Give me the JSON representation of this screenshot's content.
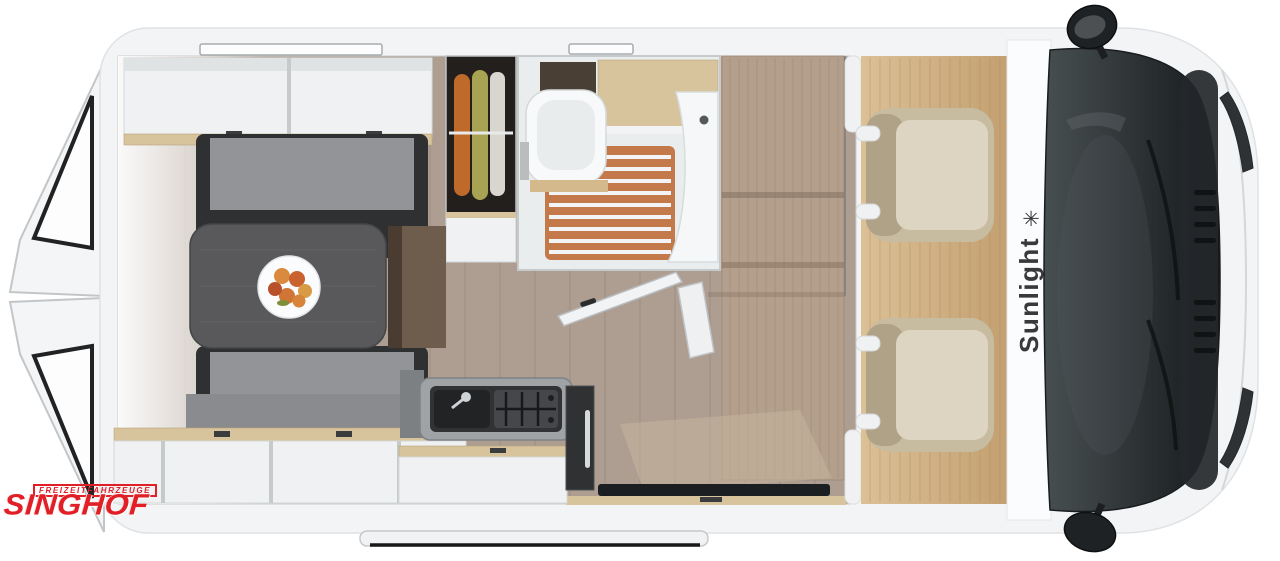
{
  "image": {
    "type": "camper-van-floorplan-top-view",
    "brand": {
      "name": "Sunlight",
      "star": "✳"
    },
    "dealer": {
      "name": "SINGHOF",
      "tagline": "FREIZEITFAHRZEUGE"
    }
  },
  "colors": {
    "page-bg": "#ffffff",
    "brand-red": "#e01f26",
    "brand-dark": "#39393b",
    "body-white": "#f3f4f6",
    "panel-white": "#eff1f2",
    "floor-wood": "#ad9e91",
    "cab-floor": "#d3b183",
    "wood-light": "#d7c39c",
    "cushion-gray": "#939497",
    "backrest-gray": "#8a8b8e",
    "bench-frame": "#2f3032",
    "table-gray": "#59595c",
    "seat-beige": "#c8bca0",
    "seat-light": "#ddd5c1",
    "windshield-dark": "#3c4345",
    "shower-wood": "#c4794b",
    "dark": "#1c1f21"
  }
}
